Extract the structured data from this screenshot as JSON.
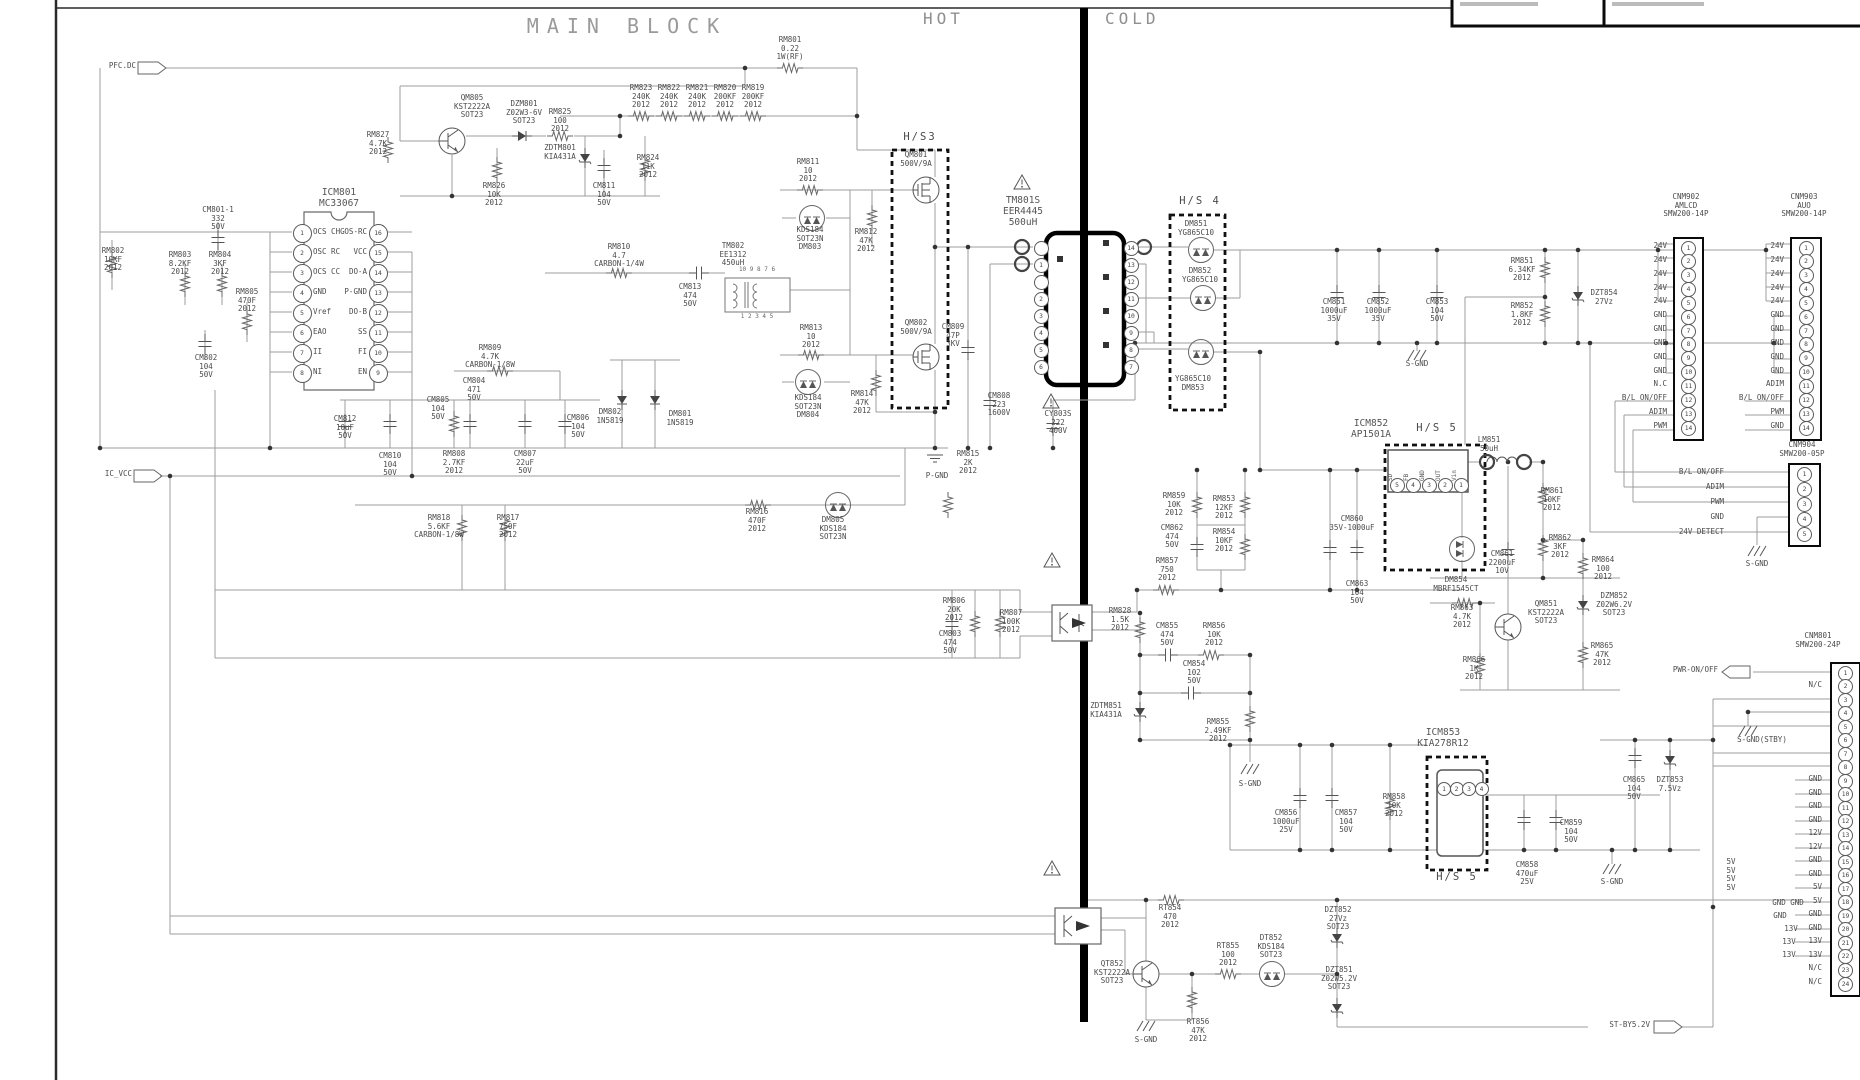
{
  "titles": {
    "main_block": "MAIN BLOCK",
    "hot": "HOT",
    "cold": "COLD"
  },
  "io_flags": [
    {
      "name": "pfc-dc",
      "label": "PFC.DC",
      "x": 136,
      "y": 62
    },
    {
      "name": "ic-vcc",
      "label": "IC_VCC",
      "x": 132,
      "y": 470
    },
    {
      "name": "pwr-on-off",
      "label": "PWR-ON/OFF",
      "x": 1718,
      "y": 666
    },
    {
      "name": "st-by-5-2v",
      "label": "ST-BY5.2V",
      "x": 1650,
      "y": 1021
    }
  ],
  "heatsinks": [
    {
      "label": "H/S3",
      "x": 920,
      "y": 132
    },
    {
      "label": "H/S 4",
      "x": 1200,
      "y": 196
    },
    {
      "label": "H/S 5",
      "x": 1437,
      "y": 423
    },
    {
      "label": "H/S 5",
      "x": 1457,
      "y": 872
    }
  ],
  "grounds": [
    {
      "label": "P-GND",
      "x": 937,
      "y": 472
    },
    {
      "label": "S-GND",
      "x": 1417,
      "y": 360
    },
    {
      "label": "S-GND",
      "x": 1250,
      "y": 780
    },
    {
      "label": "S-GND",
      "x": 1612,
      "y": 878
    },
    {
      "label": "S-GND",
      "x": 1757,
      "y": 560
    },
    {
      "label": "S-GND(STBY)",
      "x": 1762,
      "y": 736
    },
    {
      "label": "S-GND",
      "x": 1146,
      "y": 1036
    }
  ],
  "icm801": {
    "ref": "ICM801",
    "part": "MC33067",
    "left_pins": [
      {
        "n": "1",
        "fn": "OCS CHG"
      },
      {
        "n": "2",
        "fn": "OSC RC"
      },
      {
        "n": "3",
        "fn": "OCS CC"
      },
      {
        "n": "4",
        "fn": "GND"
      },
      {
        "n": "5",
        "fn": "Vref"
      },
      {
        "n": "6",
        "fn": "EAO"
      },
      {
        "n": "7",
        "fn": "II"
      },
      {
        "n": "8",
        "fn": "NI"
      }
    ],
    "right_pins": [
      {
        "n": "16",
        "fn": "OS-RC"
      },
      {
        "n": "15",
        "fn": "VCC"
      },
      {
        "n": "14",
        "fn": "DO-A"
      },
      {
        "n": "13",
        "fn": "P-GND"
      },
      {
        "n": "12",
        "fn": "DO-B"
      },
      {
        "n": "11",
        "fn": "SS"
      },
      {
        "n": "10",
        "fn": "FI"
      },
      {
        "n": "9",
        "fn": "EN"
      }
    ]
  },
  "icm852": {
    "ref": "ICM852",
    "part": "AP1501A",
    "pin_names": [
      "SD",
      "FB",
      "GND",
      "OUT",
      "Vin"
    ],
    "pin_numbers": [
      "5",
      "4",
      "3",
      "2",
      "1"
    ]
  },
  "icm853": {
    "ref": "ICM853",
    "part": "KIA278R12",
    "pin_numbers": [
      "1",
      "2",
      "3",
      "4"
    ]
  },
  "transformer": {
    "ref": "TM801S",
    "part": "EER4445",
    "value": "500uH",
    "primary_pins": [
      "",
      "1",
      "",
      "2",
      "3",
      "4",
      "5",
      "6"
    ],
    "secondary_pins": [
      "14",
      "13",
      "12",
      "11",
      "10",
      "9",
      "8",
      "7"
    ]
  },
  "tm802": {
    "ref": "TM802",
    "part": "EE1312",
    "value": "450uH",
    "top_pins": "10 9 8 7 6",
    "bottom_pins": "1 2 3 4 5"
  },
  "connectors": [
    {
      "ref": "CNM902",
      "name": "AMLCD",
      "part": "SMW200-14P",
      "x": 1673,
      "y": 237,
      "w": 27,
      "h": 200,
      "gap": 6,
      "tx": 1686,
      "ty": 202,
      "pins": [
        "24V",
        "24V",
        "24V",
        "24V",
        "24V",
        "GND",
        "GND",
        "GND",
        "GND",
        "GND",
        "N.C",
        "B/L ON/OFF",
        "ADIM",
        "PWM"
      ]
    },
    {
      "ref": "CNM903",
      "name": "AUO",
      "part": "SMW200-14P",
      "x": 1790,
      "y": 237,
      "w": 28,
      "h": 200,
      "gap": 6,
      "tx": 1804,
      "ty": 202,
      "pins": [
        "24V",
        "24V",
        "24V",
        "24V",
        "24V",
        "GND",
        "GND",
        "GND",
        "GND",
        "GND",
        "ADIM",
        "B/L ON/OFF",
        "PWM",
        "GND"
      ]
    },
    {
      "ref": "CNM904",
      "name": "",
      "part": "SMW200-05P",
      "x": 1788,
      "y": 463,
      "w": 29,
      "h": 80,
      "gap": 64,
      "tx": 1802,
      "ty": 441,
      "pins": [
        "B/L ON/OFF",
        "ADIM",
        "PWM",
        "GND",
        "24V DETECT"
      ]
    },
    {
      "ref": "CNM801",
      "name": "",
      "part": "SMW200-24P",
      "x": 1830,
      "y": 662,
      "w": 27,
      "h": 331,
      "gap": 8,
      "tx": 1818,
      "ty": 632,
      "pins": [
        "",
        "N/C",
        "",
        "",
        "",
        "",
        "",
        "",
        "GND",
        "GND",
        "GND",
        "GND",
        "12V",
        "12V",
        "GND",
        "GND",
        "5V",
        "5V",
        "GND",
        "GND",
        "13V",
        "13V",
        "N/C",
        "N/C"
      ]
    }
  ],
  "components": [
    [
      790,
      36,
      "RM801\n0.22\n1W(RF)"
    ],
    [
      641,
      84,
      "RM823\n240K\n2012"
    ],
    [
      669,
      84,
      "RM822\n240K\n2012"
    ],
    [
      697,
      84,
      "RM821\n240K\n2012"
    ],
    [
      725,
      84,
      "RM820\n200KF\n2012"
    ],
    [
      753,
      84,
      "RM819\n200KF\n2012"
    ],
    [
      472,
      94,
      "QM805\nKST2222A\nSOT23"
    ],
    [
      524,
      100,
      "DZM801\nZ02W3-6V\nSOT23"
    ],
    [
      560,
      108,
      "RM825\n100\n2012"
    ],
    [
      378,
      131,
      "RM827\n4.7K\n2012"
    ],
    [
      560,
      144,
      "ZDTM801\nKIA431A"
    ],
    [
      648,
      154,
      "RM824\n11K\n2012"
    ],
    [
      494,
      182,
      "RM826\n10K\n2012"
    ],
    [
      604,
      182,
      "CM811\n104\n50V"
    ],
    [
      218,
      206,
      "CM801-1\n332\n50V"
    ],
    [
      113,
      247,
      "RM802\n10KF\n2012"
    ],
    [
      180,
      251,
      "RM803\n8.2KF\n2012"
    ],
    [
      220,
      251,
      "RM804\n3KF\n2012"
    ],
    [
      247,
      288,
      "RM805\n470F\n2012"
    ],
    [
      206,
      354,
      "CM802\n104\n50V"
    ],
    [
      619,
      243,
      "RM810\n4.7\nCARBON-1/4W"
    ],
    [
      690,
      283,
      "CM813\n474\n50V"
    ],
    [
      808,
      158,
      "RM811\n10\n2012"
    ],
    [
      810,
      226,
      "KDS184\nSOT23N\nDM803"
    ],
    [
      866,
      228,
      "RM812\n47K\n2012"
    ],
    [
      811,
      324,
      "RM813\n10\n2012"
    ],
    [
      808,
      394,
      "KDS184\nSOT23N\nDM804"
    ],
    [
      862,
      390,
      "RM814\n47K\n2012"
    ],
    [
      610,
      408,
      "DM802\n1N5819"
    ],
    [
      680,
      410,
      "DM801\n1N5819"
    ],
    [
      916,
      151,
      "QM801\n500V/9A"
    ],
    [
      916,
      319,
      "QM802\n500V/9A"
    ],
    [
      953,
      323,
      "CM809\n47P\n3KV"
    ],
    [
      999,
      392,
      "CM808\n223\n1600V"
    ],
    [
      1058,
      410,
      "CY803S\n222\n400V"
    ],
    [
      968,
      450,
      "RM815\n2K\n2012"
    ],
    [
      757,
      508,
      "RM816\n470F\n2012"
    ],
    [
      833,
      516,
      "DM805\nKDS184\nSOT23N"
    ],
    [
      490,
      344,
      "RM809\n4.7K\nCARBON-1/8W"
    ],
    [
      474,
      377,
      "CM804\n471\n50V"
    ],
    [
      438,
      396,
      "CM805\n104\n50V"
    ],
    [
      578,
      414,
      "CM806\n104\n50V"
    ],
    [
      345,
      415,
      "CM812\n10uF\n50V"
    ],
    [
      390,
      452,
      "CM810\n104\n50V"
    ],
    [
      454,
      450,
      "RM808\n2.7KF\n2012"
    ],
    [
      525,
      450,
      "CM807\n22uF\n50V"
    ],
    [
      439,
      514,
      "RM818\n5.6KF\nCARBON-1/8W"
    ],
    [
      508,
      514,
      "RM817\n750F\n2012"
    ],
    [
      954,
      597,
      "RM806\n20K\n2012"
    ],
    [
      1011,
      609,
      "RM807\n100K\n2012"
    ],
    [
      950,
      630,
      "CM803\n474\n50V"
    ],
    [
      1196,
      220,
      "DM851\nYG865C10"
    ],
    [
      1200,
      267,
      "DM852\nYG865C10"
    ],
    [
      1193,
      375,
      "YG865C10\nDM853"
    ],
    [
      1334,
      298,
      "CM851\n1000uF\n35V"
    ],
    [
      1378,
      298,
      "CM852\n1000uF\n35V"
    ],
    [
      1437,
      298,
      "CM853\n104\n50V"
    ],
    [
      1522,
      257,
      "RM851\n6.34KF\n2012"
    ],
    [
      1522,
      302,
      "RM852\n1.8KF\n2012"
    ],
    [
      1604,
      289,
      "DZT854\n27Vz"
    ],
    [
      1489,
      436,
      "LM851\n50uH"
    ],
    [
      1174,
      492,
      "RM859\n10K\n2012"
    ],
    [
      1224,
      495,
      "RM853\n12KF\n2012"
    ],
    [
      1172,
      524,
      "CM862\n474\n50V"
    ],
    [
      1224,
      528,
      "RM854\n10KF\n2012"
    ],
    [
      1167,
      557,
      "RM857\n750\n2012"
    ],
    [
      1352,
      515,
      "CM860\n35V-1000uF"
    ],
    [
      1357,
      580,
      "CM863\n104\n50V"
    ],
    [
      1120,
      607,
      "RM828\n1.5K\n2012"
    ],
    [
      1167,
      622,
      "CM855\n474\n50V"
    ],
    [
      1214,
      622,
      "RM856\n10K\n2012"
    ],
    [
      1194,
      660,
      "CM854\n102\n50V"
    ],
    [
      1106,
      702,
      "ZDTM851\nKIA431A"
    ],
    [
      1218,
      718,
      "RM855\n2.49KF\n2012"
    ],
    [
      1456,
      576,
      "DM854\nMBRF1545CT"
    ],
    [
      1502,
      550,
      "CM861\n2200uF\n10V"
    ],
    [
      1560,
      534,
      "RM862\n3KF\n2012"
    ],
    [
      1552,
      487,
      "RM861\n10KF\n2012"
    ],
    [
      1603,
      556,
      "RM864\n100\n2012"
    ],
    [
      1614,
      592,
      "DZM852\nZ02W6.2V\nSOT23"
    ],
    [
      1462,
      604,
      "RM863\n4.7K\n2012"
    ],
    [
      1546,
      600,
      "QM851\nKST2222A\nSOT23"
    ],
    [
      1474,
      656,
      "RM866\n1K\n2012"
    ],
    [
      1602,
      642,
      "RM865\n47K\n2012"
    ],
    [
      1286,
      809,
      "CM856\n1000uF\n25V"
    ],
    [
      1346,
      809,
      "CM857\n104\n50V"
    ],
    [
      1394,
      793,
      "RM858\n10K\n2012"
    ],
    [
      1527,
      861,
      "CM858\n470uF\n25V"
    ],
    [
      1571,
      819,
      "CM859\n104\n50V"
    ],
    [
      1634,
      776,
      "CM865\n104\n50V"
    ],
    [
      1670,
      776,
      "DZT853\n7.5Vz"
    ],
    [
      1170,
      904,
      "RT854\n470\n2012"
    ],
    [
      1228,
      942,
      "RT855\n100\n2012"
    ],
    [
      1271,
      934,
      "DT852\nKDS184\nSOT23"
    ],
    [
      1338,
      906,
      "DZT852\n27Vz\nSOT23"
    ],
    [
      1339,
      966,
      "DZT851\nZ02W5.2V\nSOT23"
    ],
    [
      1198,
      1018,
      "RT856\n47K\n2012"
    ],
    [
      1112,
      960,
      "QT852\nKST2222A\nSOT23"
    ],
    [
      1731,
      858,
      "5V\n5V\n5V\n5V"
    ],
    [
      1788,
      899,
      "GND GND"
    ],
    [
      1780,
      912,
      "GND"
    ],
    [
      1791,
      925,
      "13V"
    ],
    [
      1789,
      938,
      "13V"
    ],
    [
      1789,
      951,
      "13V"
    ]
  ]
}
